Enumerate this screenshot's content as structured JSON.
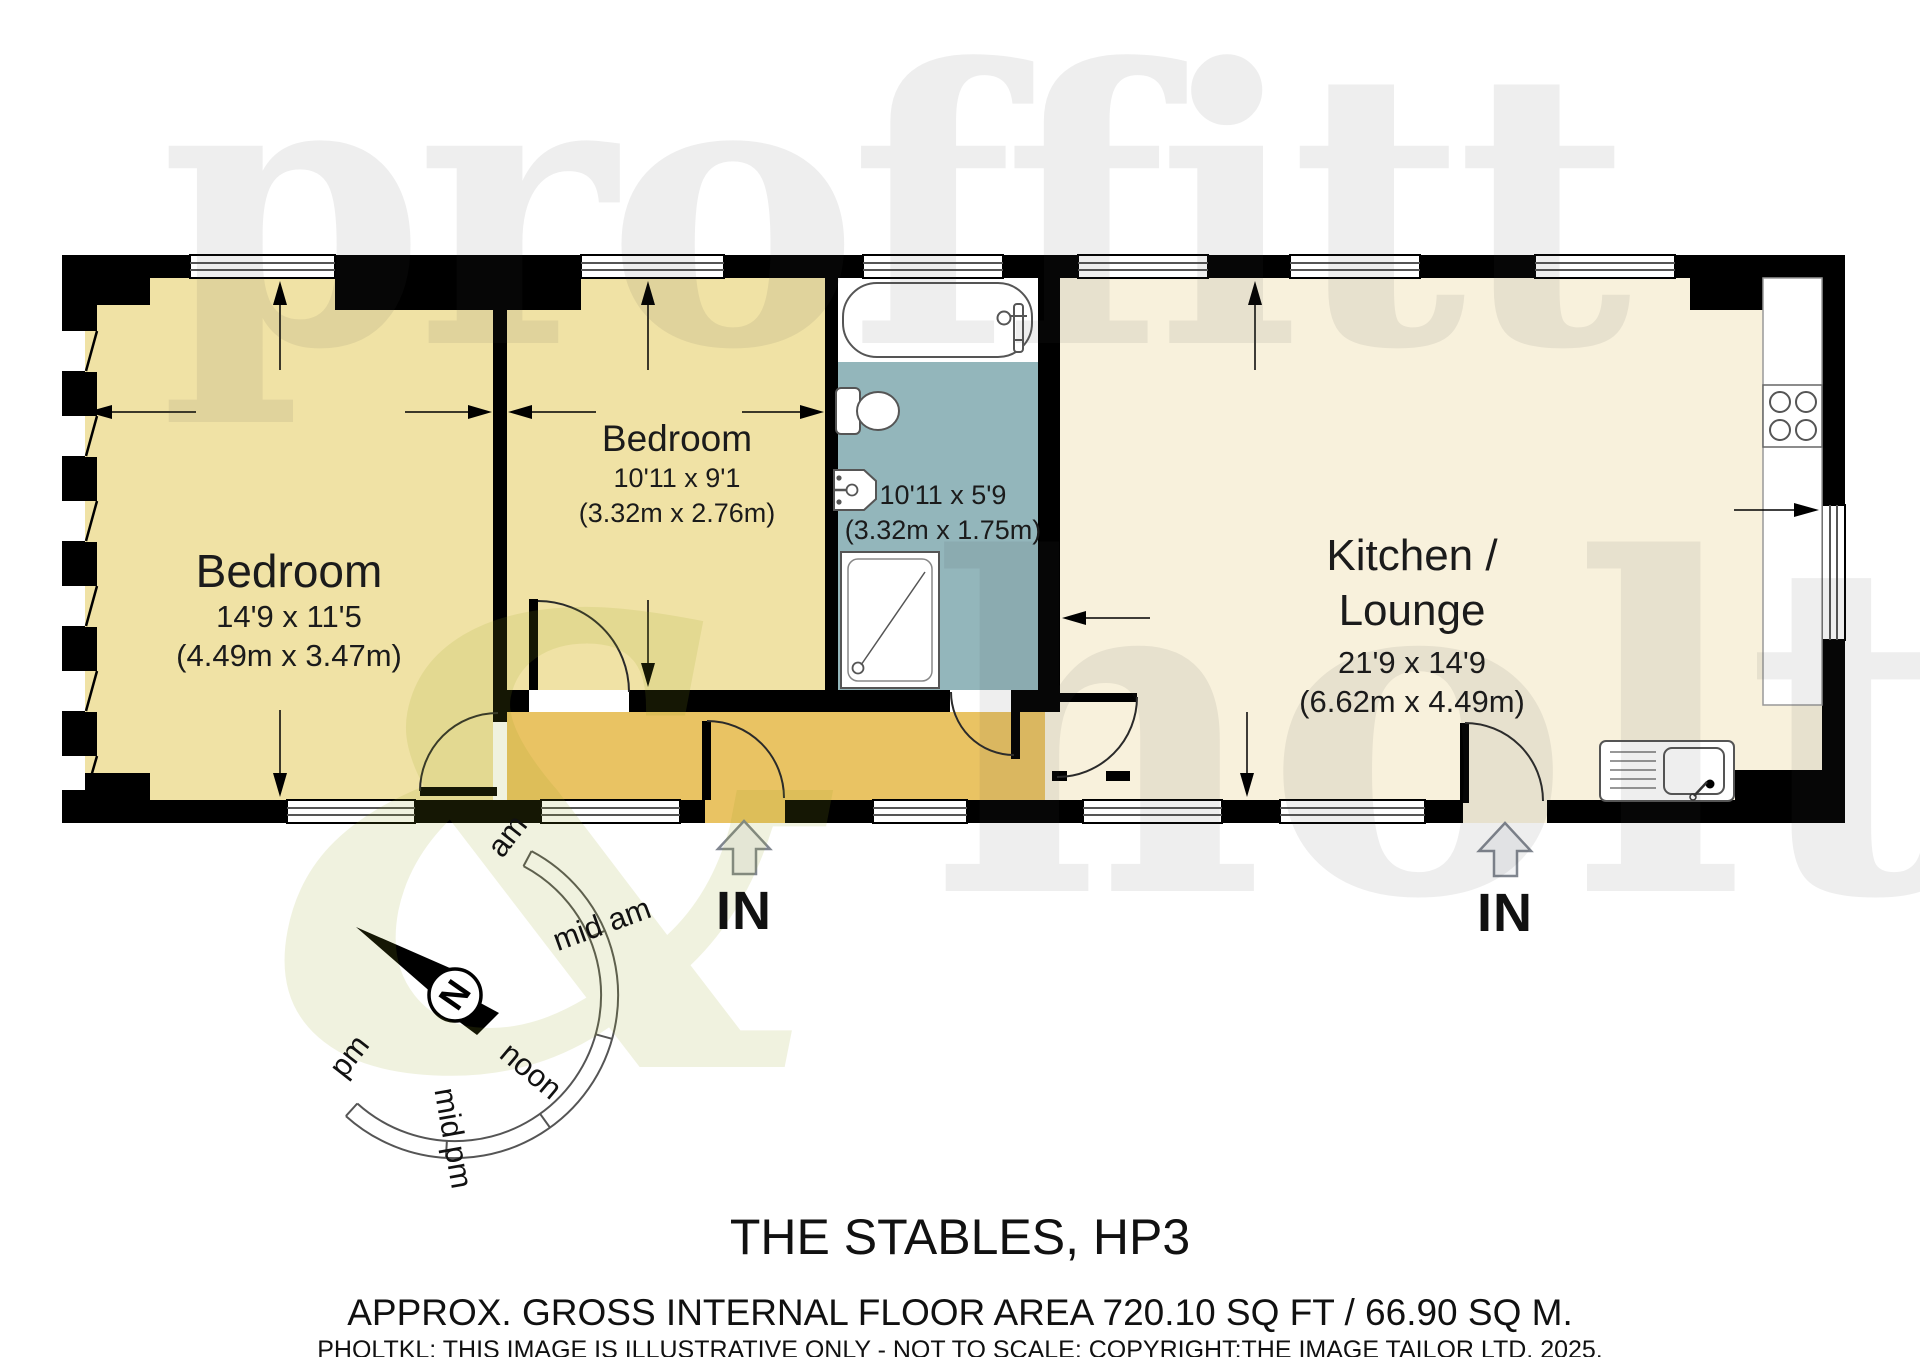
{
  "floor_plan": {
    "rooms": {
      "bedroom1": {
        "name": "Bedroom",
        "size_imperial": "14'9 x 11'5",
        "size_metric": "(4.49m x 3.47m)"
      },
      "bedroom2": {
        "name": "Bedroom",
        "size_imperial": "10'11 x 9'1",
        "size_metric": "(3.32m x 2.76m)"
      },
      "bathroom": {
        "size_imperial": "10'11 x 5'9",
        "size_metric": "(3.32m x 1.75m)"
      },
      "kitchen_lounge": {
        "name_line1": "Kitchen /",
        "name_line2": "Lounge",
        "size_imperial": "21'9 x 14'9",
        "size_metric": "(6.62m x 4.49m)"
      }
    },
    "entrances": {
      "left_label": "IN",
      "right_label": "IN"
    },
    "compass": {
      "north": "N",
      "sun_path": [
        "am",
        "mid am",
        "noon",
        "mid pm",
        "pm"
      ]
    },
    "colors": {
      "bedroom_fill": "#F0E2A5",
      "kitchen_fill": "#F8F1DC",
      "hallway_fill": "#E9C363",
      "bathroom_fill": "#93B6BB",
      "wall": "#000000",
      "window_line": "#555555"
    }
  },
  "watermark": {
    "word1": "proffitt",
    "word2": "holt",
    "symbol": "&"
  },
  "footer": {
    "title": "THE STABLES, HP3",
    "area_line": "APPROX. GROSS INTERNAL FLOOR AREA 720.10 SQ FT / 66.90 SQ M.",
    "disclaimer": "PHOLTKL: THIS IMAGE IS ILLUSTRATIVE ONLY - NOT TO SCALE: COPYRIGHT:THE IMAGE TAILOR LTD. 2025."
  }
}
